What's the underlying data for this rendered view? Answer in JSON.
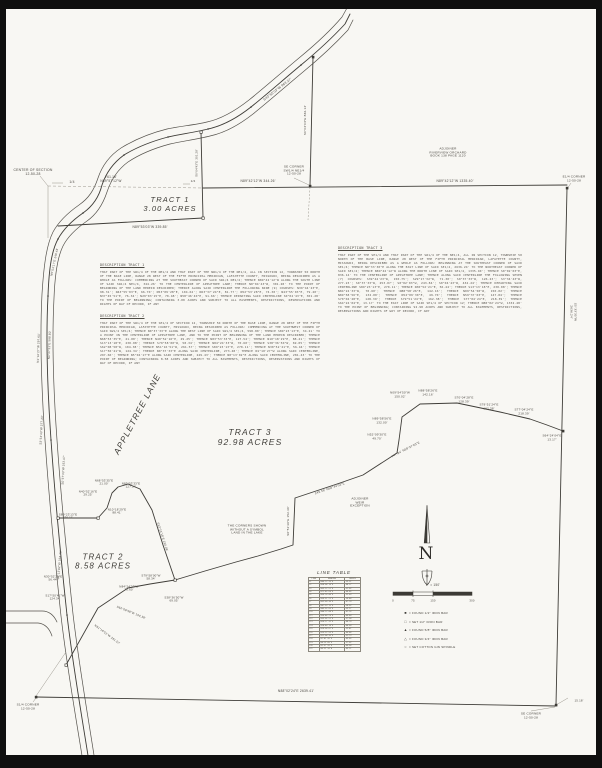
{
  "sheet": {
    "type": "boundary survey plat",
    "paper_color": "#f8f7f3",
    "ink_color": "#4d4a44"
  },
  "tracts": [
    {
      "name": "TRACT 1",
      "area": "3.00 ACRES"
    },
    {
      "name": "TRACT 2",
      "area": "8.58 ACRES"
    },
    {
      "name": "TRACT 3",
      "area": "92.98 ACRES"
    }
  ],
  "descriptions": [
    {
      "heading": "DESCRIPTION TRACT 1",
      "body": "THAT PART OF THE SW1/4 OF THE NE1/4 AND THAT PART OF THE NW1/4 OF THE NE1/4, ALL IN SECTION 12, TOWNSHIP 50 NORTH OF THE BASE LINE, RANGE 28 WEST OF THE FIFTH PRINCIPAL MERIDIAN, LAFAYETTE COUNTY, MISSOURI, BEING DESCRIBED AS A WHOLE AS FOLLOWS: COMMENCING AT THE SOUTHEAST CORNER OF SAID SW1/4 NE1/4; THENCE N89°42'12\"W ALONG THE SOUTH LINE OF SAID SW1/4 NE1/4, 344.26' TO THE CENTERLINE OF APPLETREE LANE; THENCE N0°04'43\"W, 301.28' TO THE POINT OF BEGINNING OF THE LAND HEREIN DESCRIBED; THENCE ALONG SAID CENTERLINE THE FOLLOWING NINE (9) COURSES: N39°44'23\"E, 98.31'; N43°55'03\"E, 66.70'; N53°09'28\"E, 104.62'; N63°37'24\"E, 81.77'; N52°53'28\"E, 74.30'; N43°55'03\"E, 79.20'; N37°45'51\"E, 76.34'; N29°03'15\"E, 70.48'; N58°46'40\"E, 91.66'; THENCE DEPARTING SAID CENTERLINE S0°04'43\"E, 301.28' TO THE POINT OF BEGINNING; CONTAINING 3.00 ACRES AND SUBJECT TO ALL EASEMENTS, RESTRICTIONS, RESERVATIONS AND RIGHTS OF WAY OF RECORD, IF ANY"
    },
    {
      "heading": "DESCRIPTION TRACT 2",
      "body": "THAT PART OF THE SW1/4 OF THE SE1/4 OF SECTION 12, TOWNSHIP 50 NORTH OF THE BASE LINE, RANGE 28 WEST OF THE FIFTH PRINCIPAL MERIDIAN, LAFAYETTE COUNTY, MISSOURI, BEING DESCRIBED AS FOLLOWS: COMMENCING AT THE SOUTHWEST CORNER OF SAID SW1/4 SE1/4; THENCE N0°37'33\"E ALONG THE WEST LINE OF SAID SW1/4 SE1/4, 598.80'; THENCE S89°23'13\"E, 34.21' TO A POINT IN THE CENTERLINE OF APPLETREE LANE, AND TO THE POINT OF BEGINNING OF THE LAND HEREIN DESCRIBED; THENCE N68°53'35\"E, 21.00'; THENCE N40°52'16\"E, 29.25'; THENCE N83°53'33\"E, 127.54'; THENCE N10°18'29\"E, 88.41'; THENCE S13°13'18\"E, 230.08'; THENCE S79°58'00\"W, 58.34'; THENCE N84°24'33\"W, 70.60'; THENCE S38°36'50\"W, 69.05'; THENCE S62°08'58\"W, 104.38'; THENCE N51°16'51\"W, 261.57'; THENCE S89°23'13\"E, 270.11'; THENCE N30°52'21\"E, 56.44'; THENCE S17°50'41\"W, 124.34'; THENCE N0°37'33\"E ALONG SAID CENTERLINE, 273.48'; THENCE N1°10'27\"W ALONG SAID CENTERLINE, 297.60'; THENCE N5°04'17\"E ALONG SAID CENTERLINE, 249.43'; THENCE N8°13'02\"E ALONG SAID CENTERLINE, 281.43' TO THE POINT OF BEGINNING; CONTAINING 8.58 ACRES AND SUBJECT TO ALL EASEMENTS, RESTRICTIONS, RESERVATIONS AND RIGHTS OF WAY OF RECORD, IF ANY"
    },
    {
      "heading": "DESCRIPTION TRACT 3",
      "body": "THAT PART OF THE SE1/4 AND THAT PART OF THE SW1/4 OF THE NE1/4, ALL IN SECTION 12, TOWNSHIP 50 NORTH OF THE BASE LINE, RANGE 28 WEST OF THE FIFTH PRINCIPAL MERIDIAN, LAFAYETTE COUNTY, MISSOURI, BEING DESCRIBED AS A WHOLE AS FOLLOWS: BEGINNING AT THE SOUTHEAST CORNER OF SAID SE1/4; THENCE N0°33'30\"E ALONG THE EAST LINE OF SAID SE1/4, 2636.24' TO THE NORTHEAST CORNER OF SAID SE1/4; THENCE N89°42'12\"W ALONG THE NORTH LINE OF SAID SE1/4, 1335.40'; THENCE S0°02'03\"E, 836.14' TO THE CENTERLINE OF APPLETREE LANE; THENCE ALONG SAID CENTERLINE THE FOLLOWING SEVEN (7) COURSES: S39°44'23\"W, 150.75'; S29°17'32\"W, 71.30'; S0°37'33\"W, 126.23'; S3°34'43\"W, 277.23'; S0°37'33\"W, 253.07'; S0°02'03\"W, 243.84'; S0°04'43\"W, 434.24'; THENCE DEPARTING SAID CENTERLINE S89°23'13\"E, 270.11'; THENCE N30°52'21\"E, 56.44'; THENCE S13°13'18\"E, 230.08'; THENCE N84°24'33\"W, 70.60'; THENCE N88°58'26\"E, 142.16'; THENCE N09°54'50\"W, 150.02'; THENCE N89°58'56\"E, 132.00'; THENCE N52°09'30\"E, 49.70'; THENCE N59°37'03\"E, 147.84'; THENCE S70°04'28\"E, 128.39'; THENCE S79°51'24\"E, 162.38'; THENCE S77°04'24\"E, 218.39'; THENCE S64°24'04\"E, 13.17' TO THE EAST LINE OF SAID SE1/4 OF SECTION 12; THENCE N88°02'24\"W, 1332.48' TO THE POINT OF BEGINNING; CONTAINING 92.98 ACRES AND SUBJECT TO ALL EASEMENTS, RESTRICTIONS, RESERVATIONS AND RIGHTS OF WAY OF RECORD, IF ANY"
    }
  ],
  "line_table": {
    "title": "LINE TABLE",
    "columns": [
      "LINE",
      "BEARING",
      "LENGTH"
    ],
    "rows": [
      [
        "L1",
        "N46°12'33\"E",
        "55.21'"
      ],
      [
        "L2",
        "N58°04'10\"E",
        "48.17'"
      ],
      [
        "L3",
        "N63°22'51\"E",
        "61.02'"
      ],
      [
        "L4",
        "N71°45'09\"E",
        "44.85'"
      ],
      [
        "L5",
        "N66°18'40\"E",
        "52.63'"
      ],
      [
        "L6",
        "N59°51'22\"E",
        "39.48'"
      ],
      [
        "L7",
        "N52°09'30\"E",
        "47.70'"
      ],
      [
        "L8",
        "N47°33'15\"E",
        "58.92'"
      ],
      [
        "L9",
        "N43°55'03\"E",
        "63.27'"
      ],
      [
        "L10",
        "N40°12'44\"E",
        "41.16'"
      ],
      [
        "L11",
        "N36°48'29\"E",
        "49.80'"
      ],
      [
        "L12",
        "N33°05'51\"E",
        "57.34'"
      ],
      [
        "L13",
        "N29°17'32\"E",
        "48.70'"
      ],
      [
        "L14",
        "N24°40'18\"E",
        "44.09'"
      ],
      [
        "L15",
        "N19°58'07\"E",
        "52.41'"
      ],
      [
        "L16",
        "N15°22'55\"E",
        "46.88'"
      ],
      [
        "L17",
        "N11°04'36\"E",
        "51.73'"
      ],
      [
        "L18",
        "N7°41'20\"E",
        "43.65'"
      ],
      [
        "L19",
        "N4°15'09\"E",
        "57.02'"
      ],
      [
        "L20",
        "N1°37'33\"E",
        "49.58'"
      ],
      [
        "L21",
        "N0°22'14\"W",
        "45.11'"
      ]
    ]
  },
  "legend": {
    "rows": [
      {
        "symbol": "■",
        "text": "=  FOUND 1/2\" IRON BAR"
      },
      {
        "symbol": "□",
        "text": "=  SET 1/2\" IRON BAR"
      },
      {
        "symbol": "▲",
        "text": "=  FOUND 5/8\" IRON BAR"
      },
      {
        "symbol": "△",
        "text": "=  FOUND 3/4\" IRON BAR"
      },
      {
        "symbol": "○",
        "text": "=  SET COTTON GIN SPINDLE"
      }
    ]
  },
  "labels": [
    {
      "name": "center-of-section-label",
      "text": "CENTER OF SECTION\n12-50-28",
      "x": 33,
      "y": 172,
      "fs": 3.4
    },
    {
      "name": "quarter-tick-left-label",
      "text": "1/4",
      "x": 72,
      "y": 182,
      "fs": 3.4
    },
    {
      "name": "road-offset-label",
      "text": "761.18'\nN89°57'12\"W",
      "x": 111,
      "y": 180,
      "fs": 3.2
    },
    {
      "name": "tract1-label",
      "text": "TRACT 1\n3.00 ACRES",
      "x": 170,
      "y": 205,
      "fs": 7.5,
      "it": 1
    },
    {
      "name": "tract1-south-line-label",
      "text": "N89°53'03\"W  339.85'",
      "x": 150,
      "y": 228,
      "fs": 3.3
    },
    {
      "name": "quarter-tick-mid-label",
      "text": "1/4",
      "x": 193,
      "y": 182,
      "fs": 3
    },
    {
      "name": "sw-ne-south-line-label",
      "text": "N89°42'12\"W  344.26'",
      "x": 258,
      "y": 182,
      "fs": 3.3
    },
    {
      "name": "se-corner-swne-label",
      "text": "SE CORNER\nSW1/4 NE1/4\n12-50-28",
      "x": 294,
      "y": 171,
      "fs": 3.1
    },
    {
      "name": "road-bearing-top-label",
      "text": "S43°55'03\"W  963.27'",
      "x": 278,
      "y": 90,
      "fs": 3.3,
      "rot": -38
    },
    {
      "name": "swne-east-line-label",
      "text": "S0°02'03\"E  836.14'",
      "x": 306,
      "y": 120,
      "fs": 3.1,
      "rot": -90
    },
    {
      "name": "tract1-east-line-label",
      "text": "S0°04'43\"E  301.28'",
      "x": 197,
      "y": 163,
      "fs": 2.8,
      "rot": -90
    },
    {
      "name": "adjoiner-orchard-label",
      "text": "ADJOINER\nRIVERVIEW ORCHARD\nBOOK 138 PAGE 1120",
      "x": 448,
      "y": 153,
      "fs": 3.1
    },
    {
      "name": "north-line-label",
      "text": "N89°42'12\"W  1335.40'",
      "x": 455,
      "y": 182,
      "fs": 3.3
    },
    {
      "name": "e4-corner-label",
      "text": "E1/4 CORNER\n12-50-28",
      "x": 574,
      "y": 179,
      "fs": 3.1
    },
    {
      "name": "east-line-label",
      "text": "S0°33'30\"W  2636.24'",
      "x": 573,
      "y": 312,
      "fs": 3.1,
      "rot": 90
    },
    {
      "name": "tract3-label",
      "text": "TRACT 3\n92.98 ACRES",
      "x": 250,
      "y": 437,
      "fs": 8.5,
      "it": 1
    },
    {
      "name": "lake-note-label",
      "text": "THE CORNERS SHOWN\nWITHOUT A SYMBOL\nLAND IN THE LAKE",
      "x": 247,
      "y": 530,
      "fs": 3.1
    },
    {
      "name": "adjoiner-weir-label",
      "text": "ADJOINER\nWEIR\nEXCEPTION",
      "x": 360,
      "y": 503,
      "fs": 3.1
    },
    {
      "name": "zigzag-b1-label",
      "text": "N09°54'50\"W\n150.02'",
      "x": 400,
      "y": 395,
      "fs": 3
    },
    {
      "name": "zigzag-b2-label",
      "text": "N89°58'56\"E\n132.00'",
      "x": 382,
      "y": 421,
      "fs": 3
    },
    {
      "name": "zigzag-b3-label",
      "text": "N52°09'30\"E\n49.70'",
      "x": 377,
      "y": 437,
      "fs": 3
    },
    {
      "name": "zigzag-b4-label",
      "text": "147.84'  N59°37'03\"E",
      "x": 406,
      "y": 450,
      "fs": 3,
      "rot": -27
    },
    {
      "name": "zigzag-b5-label",
      "text": "249.56'  N68°44'03\"E",
      "x": 330,
      "y": 489,
      "fs": 3,
      "rot": -19
    },
    {
      "name": "zigzag-b6-label",
      "text": "S0°51'39\"E  152.30'",
      "x": 289,
      "y": 521,
      "fs": 3,
      "rot": -90
    },
    {
      "name": "zigzag-b7-label",
      "text": "N88°58'26\"E\n142.16'",
      "x": 428,
      "y": 393,
      "fs": 3
    },
    {
      "name": "zigzag-b8-label",
      "text": "S70°04'28\"E\n128.39'",
      "x": 464,
      "y": 400,
      "fs": 3
    },
    {
      "name": "zigzag-b9-label",
      "text": "S79°51'24\"E\n162.38'",
      "x": 489,
      "y": 407,
      "fs": 3
    },
    {
      "name": "zigzag-b10-label",
      "text": "S77°04'24\"E\n218.39'",
      "x": 524,
      "y": 412,
      "fs": 3
    },
    {
      "name": "zigzag-b11-label",
      "text": "S64°24'04\"E\n13.17'",
      "x": 552,
      "y": 438,
      "fs": 3
    },
    {
      "name": "tract2-label",
      "text": "TRACT 2\n8.58 ACRES",
      "x": 103,
      "y": 562,
      "fs": 8,
      "it": 1
    },
    {
      "name": "tract2-b1-label",
      "text": "N68°53'35\"E\n21.00'",
      "x": 104,
      "y": 483,
      "fs": 2.9
    },
    {
      "name": "tract2-b2-label",
      "text": "N83°53'33\"E\n127.54'",
      "x": 131,
      "y": 486,
      "fs": 2.9
    },
    {
      "name": "tract2-b3-label",
      "text": "N40°52'16\"E\n29.25'",
      "x": 88,
      "y": 494,
      "fs": 2.9
    },
    {
      "name": "tract2-b4-label",
      "text": "N10°18'29\"E\n88.41'",
      "x": 117,
      "y": 512,
      "fs": 2.9
    },
    {
      "name": "tract2-b5-label",
      "text": "S89°23'13\"E\n270.11'",
      "x": 68,
      "y": 517,
      "fs": 2.9
    },
    {
      "name": "tract2-b6-label",
      "text": "S13°13'18\"E  230.08'",
      "x": 162,
      "y": 537,
      "fs": 2.9,
      "rot": 72
    },
    {
      "name": "tract2-b7-label",
      "text": "N30°52'21\"E\n56.44'",
      "x": 53,
      "y": 579,
      "fs": 2.9
    },
    {
      "name": "tract2-b8-label",
      "text": "S17°50'41\"W\n124.34'",
      "x": 55,
      "y": 598,
      "fs": 2.9
    },
    {
      "name": "tract2-b9-label",
      "text": "S79°58'00\"W\n58.34'",
      "x": 151,
      "y": 578,
      "fs": 2.9
    },
    {
      "name": "tract2-b10-label",
      "text": "N84°24'33\"W\n70.60'",
      "x": 129,
      "y": 589,
      "fs": 2.9
    },
    {
      "name": "tract2-b11-label",
      "text": "S38°36'50\"W\n69.05'",
      "x": 174,
      "y": 600,
      "fs": 2.9
    },
    {
      "name": "tract2-b12-label",
      "text": "S62°08'58\"W  104.38'",
      "x": 131,
      "y": 613,
      "fs": 2.9,
      "rot": 22
    },
    {
      "name": "tract2-b13-label",
      "text": "N51°16'51\"W  261.57'",
      "x": 107,
      "y": 635,
      "fs": 2.9,
      "rot": 37
    },
    {
      "name": "street-name-label",
      "text": "APPLETREE  LANE",
      "x": 137,
      "y": 414,
      "fs": 8.5,
      "it": 1,
      "rot": -62
    },
    {
      "name": "road-b1-label",
      "text": "N0°37'33\"E  598.80'",
      "x": 50,
      "y": 345,
      "fs": 2.9,
      "rot": -88
    },
    {
      "name": "road-b2-label",
      "text": "N1°10'27\"W  297.60'",
      "x": 39,
      "y": 348,
      "fs": 2.9,
      "rot": -88
    },
    {
      "name": "road-b3-label",
      "text": "N5°04'17\"E  249.43'",
      "x": 55,
      "y": 262,
      "fs": 2.9,
      "rot": -78
    },
    {
      "name": "road-b4-label",
      "text": "S8°13'02\"W  334.43'",
      "x": 60,
      "y": 565,
      "fs": 2.9,
      "rot": -85
    },
    {
      "name": "road-b5-label",
      "text": "S0°37'33\"W  253.07'",
      "x": 64,
      "y": 470,
      "fs": 2.9,
      "rot": -87
    },
    {
      "name": "road-b6-label",
      "text": "S3°34'43\"W  277.23'",
      "x": 42,
      "y": 430,
      "fs": 2.9,
      "rot": -87
    },
    {
      "name": "s4-corner-label",
      "text": "S1/4 CORNER\n12-50-28",
      "x": 28,
      "y": 707,
      "fs": 3.1
    },
    {
      "name": "south-line-label",
      "text": "N88°02'24\"E  2639.41'",
      "x": 296,
      "y": 692,
      "fs": 3.3
    },
    {
      "name": "se-corner-label",
      "text": "SE CORNER\n12-50-28",
      "x": 531,
      "y": 716,
      "fs": 3.1
    },
    {
      "name": "tie-distance-label",
      "text": "15.18'",
      "x": 579,
      "y": 701,
      "fs": 2.9
    },
    {
      "name": "north-letter",
      "text": "N",
      "x": 426,
      "y": 554,
      "fs": 17,
      "serif": 1
    },
    {
      "name": "scale-ratio-label",
      "text": "1\" = 150'",
      "x": 433,
      "y": 586,
      "fs": 3.2
    },
    {
      "name": "scale-tick-0",
      "text": "0",
      "x": 393,
      "y": 601,
      "fs": 2.8
    },
    {
      "name": "scale-tick-75",
      "text": "75",
      "x": 413,
      "y": 601,
      "fs": 2.8
    },
    {
      "name": "scale-tick-150",
      "text": "150",
      "x": 433,
      "y": 601,
      "fs": 2.8
    },
    {
      "name": "scale-tick-300",
      "text": "300",
      "x": 472,
      "y": 601,
      "fs": 2.8
    }
  ]
}
